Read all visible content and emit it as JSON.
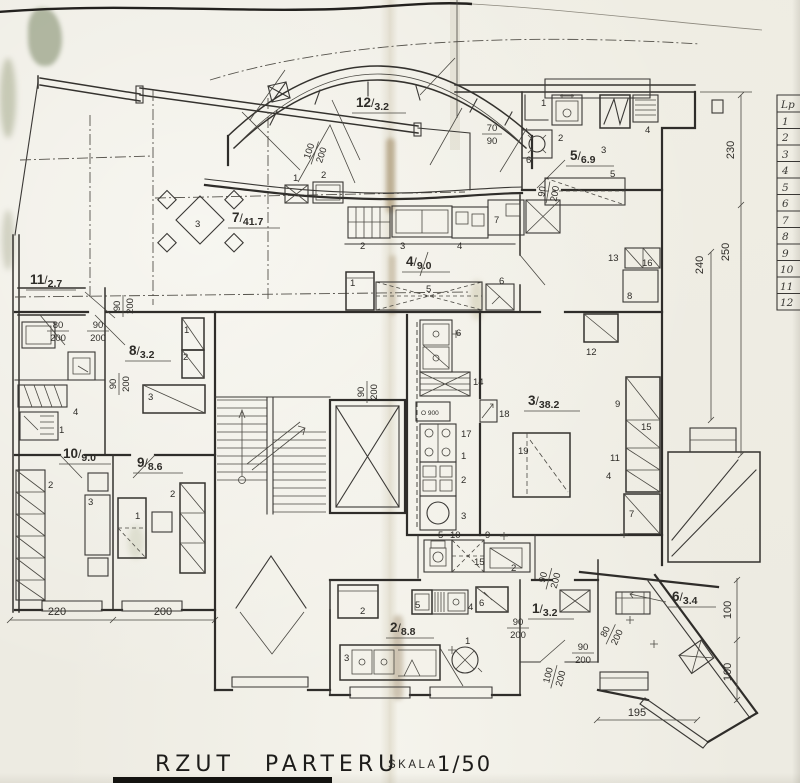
{
  "drawing": {
    "title": "RZUT PARTERU",
    "scale_label": "SKALA",
    "scale_value": "1/50",
    "sep": "/"
  },
  "rooms": {
    "r1": {
      "n": "1",
      "a": "3.2"
    },
    "r2": {
      "n": "2",
      "a": "8.8"
    },
    "r3": {
      "n": "3",
      "a": "38.2"
    },
    "r4": {
      "n": "4",
      "a": "9.0"
    },
    "r5": {
      "n": "5",
      "a": "6.9"
    },
    "r6": {
      "n": "6",
      "a": "3.4"
    },
    "r7": {
      "n": "7",
      "a": "41.7"
    },
    "r8": {
      "n": "8",
      "a": "3.2"
    },
    "r9": {
      "n": "9",
      "a": "8.6"
    },
    "r10": {
      "n": "10",
      "a": "9.0"
    },
    "r11": {
      "n": "11",
      "a": "2.7"
    },
    "r12": {
      "n": "12",
      "a": "3.2"
    }
  },
  "dims": {
    "v70": "70",
    "v80": "80",
    "v90": "90",
    "v100": "100",
    "v200": "200"
  },
  "linear": {
    "b220": "220",
    "b200": "200",
    "b195": "195",
    "r230": "230",
    "r250": "250",
    "r240": "240",
    "v100": "100"
  },
  "items": {
    "n1": "1",
    "n2": "2",
    "n3": "3",
    "n4": "4",
    "n5": "5",
    "n6": "6",
    "n7": "7",
    "n8": "8",
    "n9": "9",
    "n10": "10",
    "n11": "11",
    "n12": "12",
    "n13": "13",
    "n14": "14",
    "n15": "15",
    "n16": "16",
    "n17": "17",
    "n18": "18",
    "n19": "19",
    "o900": "O 900"
  },
  "legend": {
    "header": "Lp",
    "rows": [
      "1",
      "2",
      "3",
      "4",
      "5",
      "6",
      "7",
      "8",
      "9",
      "10",
      "11",
      "12"
    ]
  }
}
